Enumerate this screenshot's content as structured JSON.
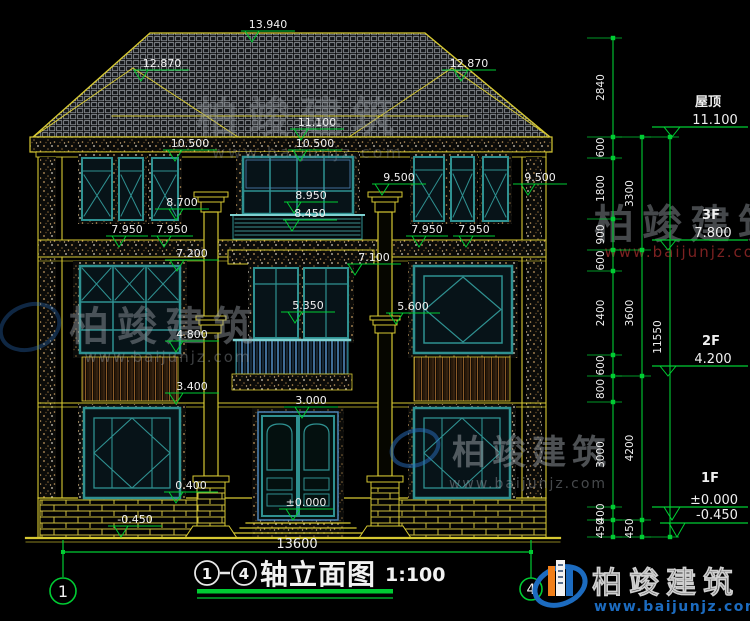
{
  "drawing": {
    "title": {
      "axis_from": "1",
      "axis_to": "4",
      "text": "轴立面图",
      "scale": "1:100"
    },
    "axes": [
      "1",
      "4"
    ],
    "bottom_dimension": "13600",
    "watermark": {
      "name": "柏竣建筑",
      "url": "www.baijunjz.com"
    },
    "logo": {
      "name": "柏竣建筑",
      "url": "www.baijunjz.com"
    },
    "colors": {
      "line_yellow": "#d6c832",
      "frame_teal": "#2f9191",
      "dim_green": "#00cc33",
      "text_white": "#f0f0f0",
      "watermark_gray": "#9aa0a6",
      "watermark_red": "#9c2a2a",
      "logo_blue": "#1c6bbf"
    },
    "elevation_markers": [
      {
        "label": "13.940",
        "x": 268,
        "y": 31,
        "tri": 252
      },
      {
        "label": "12.870",
        "x": 162,
        "y": 70,
        "tri": 141
      },
      {
        "label": "12.870",
        "x": 469,
        "y": 70,
        "tri": 461
      },
      {
        "label": "11.100",
        "x": 317,
        "y": 129,
        "tri": 301
      },
      {
        "label": "10.500",
        "x": 190,
        "y": 150,
        "tri": 175
      },
      {
        "label": "10.500",
        "x": 315,
        "y": 150,
        "tri": 300
      },
      {
        "label": "9.500",
        "x": 399,
        "y": 184,
        "tri": 382
      },
      {
        "label": "9.500",
        "x": 540,
        "y": 184,
        "tri": 528
      },
      {
        "label": "8.950",
        "x": 311,
        "y": 202,
        "tri": 294
      },
      {
        "label": "8.450",
        "x": 310,
        "y": 220,
        "tri": 292
      },
      {
        "label": "8.700",
        "x": 182,
        "y": 209,
        "tri": 176
      },
      {
        "label": "7.950",
        "x": 127,
        "y": 236,
        "tri": 119,
        "len": 42
      },
      {
        "label": "7.950",
        "x": 172,
        "y": 236,
        "tri": 164,
        "len": 42
      },
      {
        "label": "7.950",
        "x": 427,
        "y": 236,
        "tri": 419,
        "len": 42
      },
      {
        "label": "7.950",
        "x": 474,
        "y": 236,
        "tri": 466,
        "len": 42
      },
      {
        "label": "7.200",
        "x": 192,
        "y": 260,
        "tri": 177
      },
      {
        "label": "7.100",
        "x": 374,
        "y": 264,
        "tri": 355
      },
      {
        "label": "5.600",
        "x": 413,
        "y": 313,
        "tri": 396
      },
      {
        "label": "5.350",
        "x": 308,
        "y": 312,
        "tri": 295
      },
      {
        "label": "4.800",
        "x": 192,
        "y": 341,
        "tri": 176
      },
      {
        "label": "3.400",
        "x": 192,
        "y": 393,
        "tri": 176
      },
      {
        "label": "3.000",
        "x": 311,
        "y": 407,
        "tri": 302
      },
      {
        "label": "0.400",
        "x": 191,
        "y": 492,
        "tri": 176
      },
      {
        "label": "±0.000",
        "x": 306,
        "y": 509,
        "tri": 293
      },
      {
        "label": "-0.450",
        "x": 135,
        "y": 526,
        "tri": 121
      }
    ],
    "dimension_columns": [
      {
        "x": 613,
        "label_x": 604,
        "ticks": [
          38,
          137,
          158,
          219,
          250,
          271,
          355,
          376,
          402,
          507,
          520,
          537
        ],
        "segments": [
          "2840",
          "600",
          "1800",
          "900",
          "600",
          "2400",
          "600",
          "800",
          "3000",
          "400",
          "450"
        ]
      },
      {
        "x": 642,
        "label_x": 633,
        "ticks": [
          137,
          250,
          376,
          520,
          537
        ],
        "segments": [
          "3300",
          "3600",
          "4200",
          "450"
        ]
      },
      {
        "x": 670,
        "label_x": 661,
        "ticks": [
          137,
          537
        ],
        "segments": [
          "11550"
        ]
      }
    ],
    "level_labels": [
      {
        "name": "屋顶",
        "value": "11.100",
        "line": 127,
        "apex": 137,
        "tri": 672,
        "x1": 652,
        "x2": 748,
        "name_x": 708,
        "name_y": 106,
        "val_x": 715,
        "val_y": 124
      },
      {
        "name": "3F",
        "value": "7.800",
        "line": 240,
        "apex": 250,
        "tri": 668,
        "x1": 652,
        "x2": 748,
        "name_x": 711,
        "name_y": 219,
        "val_x": 713,
        "val_y": 237
      },
      {
        "name": "2F",
        "value": "4.200",
        "line": 366,
        "apex": 376,
        "tri": 668,
        "x1": 652,
        "x2": 748,
        "name_x": 711,
        "name_y": 345,
        "val_x": 713,
        "val_y": 363
      },
      {
        "name": "1F",
        "value": "±0.000",
        "line": 507,
        "apex": 520,
        "tri": 672,
        "x1": 652,
        "x2": 748,
        "name_x": 710,
        "name_y": 482,
        "val_x": 714,
        "val_y": 504
      },
      {
        "name": "",
        "value": "-0.450",
        "line": 523,
        "apex": 537,
        "tri": 677,
        "x1": 660,
        "x2": 748,
        "name_x": 0,
        "name_y": 0,
        "val_x": 717,
        "val_y": 519
      }
    ]
  }
}
